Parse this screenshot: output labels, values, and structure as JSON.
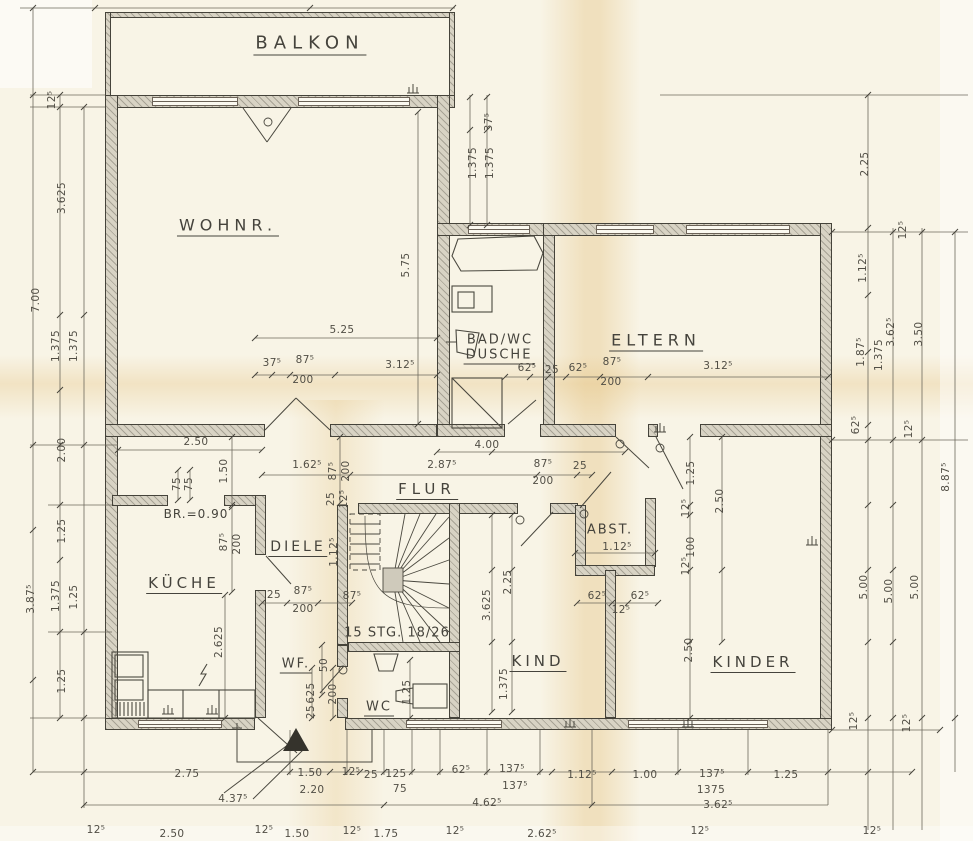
{
  "drawing": {
    "type": "floor-plan",
    "language": "de",
    "colors": {
      "paper": "#f8f4e6",
      "line": "#514e45",
      "wall_fill": "#d8d3c4",
      "wall_edge": "#45433a",
      "stain": "#deb260"
    }
  },
  "rooms": [
    {
      "id": "balkon",
      "label": "BALKON",
      "x": 310,
      "y": 44,
      "fs": 18,
      "u": 1,
      "ls": 6
    },
    {
      "id": "wohnr",
      "label": "WOHNR.",
      "x": 228,
      "y": 226,
      "fs": 16,
      "u": 1,
      "ls": 5
    },
    {
      "id": "badwc",
      "label": "BAD/WC",
      "x": 500,
      "y": 340,
      "fs": 13,
      "u": 0,
      "ls": 2
    },
    {
      "id": "dusche",
      "label": "DUSCHE",
      "x": 499,
      "y": 356,
      "fs": 13,
      "u": 1,
      "ls": 2
    },
    {
      "id": "eltern",
      "label": "ELTERN",
      "x": 656,
      "y": 341,
      "fs": 16,
      "u": 1,
      "ls": 5
    },
    {
      "id": "flur",
      "label": "FLUR",
      "x": 427,
      "y": 490,
      "fs": 15,
      "u": 1,
      "ls": 5
    },
    {
      "id": "diele",
      "label": "DIELE",
      "x": 298,
      "y": 548,
      "fs": 14,
      "u": 1,
      "ls": 3
    },
    {
      "id": "kueche",
      "label": "KÜCHE",
      "x": 184,
      "y": 584,
      "fs": 15,
      "u": 1,
      "ls": 4
    },
    {
      "id": "abst",
      "label": "ABST.",
      "x": 610,
      "y": 530,
      "fs": 13,
      "u": 0,
      "ls": 2
    },
    {
      "id": "kind",
      "label": "KIND",
      "x": 538,
      "y": 662,
      "fs": 15,
      "u": 1,
      "ls": 4
    },
    {
      "id": "kinder",
      "label": "KINDER",
      "x": 753,
      "y": 663,
      "fs": 15,
      "u": 1,
      "ls": 4
    },
    {
      "id": "wf",
      "label": "WF.",
      "x": 296,
      "y": 665,
      "fs": 13,
      "u": 1,
      "ls": 2
    },
    {
      "id": "wc",
      "label": "WC",
      "x": 379,
      "y": 708,
      "fs": 13,
      "u": 1,
      "ls": 2
    },
    {
      "id": "stair-note",
      "label": "15 STG. 18/26",
      "x": 397,
      "y": 633,
      "fs": 13,
      "u": 0,
      "ls": 1
    },
    {
      "id": "door-note",
      "label": "BR.=0.90",
      "x": 196,
      "y": 514,
      "fs": 12,
      "u": 0,
      "ls": 1
    }
  ],
  "dims": [
    {
      "t": "12⁵",
      "x": 52,
      "y": 100,
      "r": 1
    },
    {
      "t": "3.625",
      "x": 62,
      "y": 198,
      "r": 1
    },
    {
      "t": "7.00",
      "x": 36,
      "y": 300,
      "r": 1
    },
    {
      "t": "1.375",
      "x": 56,
      "y": 346,
      "r": 1
    },
    {
      "t": "1.375",
      "x": 74,
      "y": 346,
      "r": 1
    },
    {
      "t": "2.00",
      "x": 62,
      "y": 450,
      "r": 1
    },
    {
      "t": "1.25",
      "x": 62,
      "y": 531,
      "r": 1
    },
    {
      "t": "3.87⁵",
      "x": 31,
      "y": 599,
      "r": 1
    },
    {
      "t": "1.375",
      "x": 56,
      "y": 596,
      "r": 1
    },
    {
      "t": "1.25",
      "x": 74,
      "y": 597,
      "r": 1
    },
    {
      "t": "1.25",
      "x": 62,
      "y": 681,
      "r": 1
    },
    {
      "t": "37⁵",
      "x": 489,
      "y": 122,
      "r": 1
    },
    {
      "t": "1.375",
      "x": 473,
      "y": 163,
      "r": 1
    },
    {
      "t": "1.375",
      "x": 490,
      "y": 163,
      "r": 1
    },
    {
      "t": "2.25",
      "x": 865,
      "y": 164,
      "r": 1
    },
    {
      "t": "12⁵",
      "x": 903,
      "y": 230,
      "r": 1
    },
    {
      "t": "1.12⁵",
      "x": 863,
      "y": 268,
      "r": 1
    },
    {
      "t": "3.62⁵",
      "x": 891,
      "y": 332,
      "r": 1
    },
    {
      "t": "3.50",
      "x": 919,
      "y": 334,
      "r": 1
    },
    {
      "t": "1.87⁵",
      "x": 861,
      "y": 352,
      "r": 1
    },
    {
      "t": "1.375",
      "x": 879,
      "y": 355,
      "r": 1
    },
    {
      "t": "62⁵",
      "x": 856,
      "y": 425,
      "r": 1
    },
    {
      "t": "12⁵",
      "x": 909,
      "y": 429,
      "r": 1
    },
    {
      "t": "8.87⁵",
      "x": 946,
      "y": 477,
      "r": 1
    },
    {
      "t": "5.00",
      "x": 864,
      "y": 587,
      "r": 1
    },
    {
      "t": "5.00",
      "x": 889,
      "y": 591,
      "r": 1
    },
    {
      "t": "5.00",
      "x": 915,
      "y": 587,
      "r": 1
    },
    {
      "t": "12⁵",
      "x": 854,
      "y": 721,
      "r": 1
    },
    {
      "t": "12⁵",
      "x": 907,
      "y": 723,
      "r": 1
    },
    {
      "t": "5.75",
      "x": 406,
      "y": 265,
      "r": 1
    },
    {
      "t": "5.25",
      "x": 342,
      "y": 330,
      "r": 0
    },
    {
      "t": "37⁵",
      "x": 272,
      "y": 363,
      "r": 0
    },
    {
      "t": "87⁵",
      "x": 305,
      "y": 360,
      "r": 0
    },
    {
      "t": "200",
      "x": 303,
      "y": 380,
      "r": 0
    },
    {
      "t": "3.12⁵",
      "x": 400,
      "y": 365,
      "r": 0
    },
    {
      "t": "62⁵",
      "x": 527,
      "y": 368,
      "r": 0
    },
    {
      "t": "25",
      "x": 552,
      "y": 370,
      "r": 0
    },
    {
      "t": "62⁵",
      "x": 578,
      "y": 368,
      "r": 0
    },
    {
      "t": "87⁵",
      "x": 612,
      "y": 362,
      "r": 0
    },
    {
      "t": "200",
      "x": 611,
      "y": 382,
      "r": 0
    },
    {
      "t": "3.12⁵",
      "x": 718,
      "y": 366,
      "r": 0
    },
    {
      "t": "2.50",
      "x": 196,
      "y": 442,
      "r": 0
    },
    {
      "t": "1.50",
      "x": 224,
      "y": 471,
      "r": 1
    },
    {
      "t": "75",
      "x": 177,
      "y": 484,
      "r": 1
    },
    {
      "t": "75",
      "x": 189,
      "y": 484,
      "r": 1
    },
    {
      "t": "1.62⁵",
      "x": 307,
      "y": 465,
      "r": 0
    },
    {
      "t": "87⁵",
      "x": 333,
      "y": 471,
      "r": 1
    },
    {
      "t": "200",
      "x": 346,
      "y": 471,
      "r": 1
    },
    {
      "t": "25",
      "x": 331,
      "y": 499,
      "r": 1
    },
    {
      "t": "12⁵",
      "x": 344,
      "y": 499,
      "r": 1
    },
    {
      "t": "4.00",
      "x": 487,
      "y": 445,
      "r": 0
    },
    {
      "t": "2.87⁵",
      "x": 442,
      "y": 465,
      "r": 0
    },
    {
      "t": "87⁵",
      "x": 543,
      "y": 464,
      "r": 0
    },
    {
      "t": "200",
      "x": 543,
      "y": 481,
      "r": 0
    },
    {
      "t": "25",
      "x": 580,
      "y": 466,
      "r": 0
    },
    {
      "t": "87⁵",
      "x": 224,
      "y": 542,
      "r": 1
    },
    {
      "t": "200",
      "x": 237,
      "y": 544,
      "r": 1
    },
    {
      "t": "1.12⁵",
      "x": 334,
      "y": 552,
      "r": 1
    },
    {
      "t": "25",
      "x": 274,
      "y": 595,
      "r": 0
    },
    {
      "t": "87⁵",
      "x": 303,
      "y": 591,
      "r": 0
    },
    {
      "t": "200",
      "x": 303,
      "y": 609,
      "r": 0
    },
    {
      "t": "87⁵",
      "x": 352,
      "y": 596,
      "r": 0
    },
    {
      "t": "2.625",
      "x": 219,
      "y": 642,
      "r": 1
    },
    {
      "t": "50",
      "x": 324,
      "y": 665,
      "r": 1
    },
    {
      "t": "625",
      "x": 311,
      "y": 693,
      "r": 1
    },
    {
      "t": "200",
      "x": 333,
      "y": 694,
      "r": 1
    },
    {
      "t": "25",
      "x": 311,
      "y": 712,
      "r": 1
    },
    {
      "t": "1.25",
      "x": 407,
      "y": 692,
      "r": 1
    },
    {
      "t": "2.25",
      "x": 508,
      "y": 582,
      "r": 1
    },
    {
      "t": "3.625",
      "x": 487,
      "y": 605,
      "r": 1
    },
    {
      "t": "1.375",
      "x": 504,
      "y": 684,
      "r": 1
    },
    {
      "t": "1.12⁵",
      "x": 617,
      "y": 547,
      "r": 0
    },
    {
      "t": "62⁵",
      "x": 597,
      "y": 596,
      "r": 0
    },
    {
      "t": "62⁵",
      "x": 640,
      "y": 596,
      "r": 0
    },
    {
      "t": "12⁵",
      "x": 621,
      "y": 610,
      "r": 0
    },
    {
      "t": "1.25",
      "x": 691,
      "y": 473,
      "r": 1
    },
    {
      "t": "12⁵",
      "x": 686,
      "y": 508,
      "r": 1
    },
    {
      "t": "100",
      "x": 691,
      "y": 547,
      "r": 1
    },
    {
      "t": "12⁵",
      "x": 686,
      "y": 566,
      "r": 1
    },
    {
      "t": "2.50",
      "x": 720,
      "y": 501,
      "r": 1
    },
    {
      "t": "2.50",
      "x": 689,
      "y": 650,
      "r": 1
    },
    {
      "t": "2.75",
      "x": 187,
      "y": 774,
      "r": 0
    },
    {
      "t": "1.50",
      "x": 310,
      "y": 773,
      "r": 0
    },
    {
      "t": "2.20",
      "x": 312,
      "y": 790,
      "r": 0
    },
    {
      "t": "12⁵",
      "x": 351,
      "y": 772,
      "r": 0
    },
    {
      "t": "25",
      "x": 371,
      "y": 775,
      "r": 0
    },
    {
      "t": "125",
      "x": 396,
      "y": 774,
      "r": 0
    },
    {
      "t": "75",
      "x": 400,
      "y": 789,
      "r": 0
    },
    {
      "t": "62⁵",
      "x": 461,
      "y": 770,
      "r": 0
    },
    {
      "t": "137⁵",
      "x": 512,
      "y": 769,
      "r": 0
    },
    {
      "t": "137⁵",
      "x": 515,
      "y": 786,
      "r": 0
    },
    {
      "t": "1.12⁵",
      "x": 582,
      "y": 775,
      "r": 0
    },
    {
      "t": "1.00",
      "x": 645,
      "y": 775,
      "r": 0
    },
    {
      "t": "137⁵",
      "x": 712,
      "y": 774,
      "r": 0
    },
    {
      "t": "1375",
      "x": 711,
      "y": 790,
      "r": 0
    },
    {
      "t": "1.25",
      "x": 786,
      "y": 775,
      "r": 0
    },
    {
      "t": "4.37⁵",
      "x": 233,
      "y": 799,
      "r": 0
    },
    {
      "t": "4.62⁵",
      "x": 487,
      "y": 803,
      "r": 0
    },
    {
      "t": "3.62⁵",
      "x": 718,
      "y": 805,
      "r": 0
    },
    {
      "t": "12⁵",
      "x": 96,
      "y": 830,
      "r": 0
    },
    {
      "t": "2.50",
      "x": 172,
      "y": 834,
      "r": 0
    },
    {
      "t": "12⁵",
      "x": 264,
      "y": 830,
      "r": 0
    },
    {
      "t": "1.50",
      "x": 297,
      "y": 834,
      "r": 0
    },
    {
      "t": "12⁵",
      "x": 352,
      "y": 831,
      "r": 0
    },
    {
      "t": "1.75",
      "x": 386,
      "y": 834,
      "r": 0
    },
    {
      "t": "12⁵",
      "x": 455,
      "y": 831,
      "r": 0
    },
    {
      "t": "2.62⁵",
      "x": 542,
      "y": 834,
      "r": 0
    },
    {
      "t": "12⁵",
      "x": 700,
      "y": 831,
      "r": 0
    },
    {
      "t": "12⁵",
      "x": 872,
      "y": 831,
      "r": 0
    }
  ]
}
